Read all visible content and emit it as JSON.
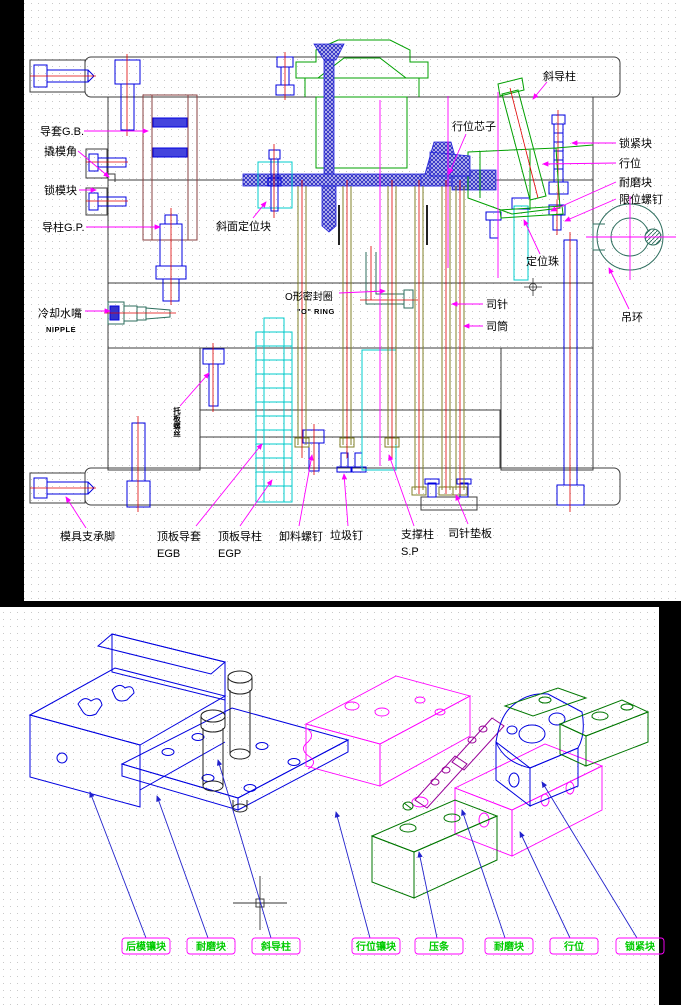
{
  "drawing": {
    "type": "mold-design-cad-drawing",
    "colors": {
      "background": "#000000",
      "paper": "#ffffff",
      "grid_dot": "#c9c9c9",
      "outline": "#3c3c3c",
      "blue": "#0000e0",
      "magenta": "#ff00ff",
      "green": "#00a000",
      "bright_green": "#00cc00",
      "cyan": "#00cccc",
      "red_centerline": "#e00000",
      "olive": "#808028",
      "dark_green": "#2e6e5e",
      "purple": "#990099"
    }
  },
  "top_view": {
    "labels": {
      "guide_bushing": "导套G.B.",
      "pry_slot": "撬模角",
      "mold_lock_block": "锁模块",
      "guide_pin": "导柱G.P.",
      "taper_locating_block": "斜面定位块",
      "cooling_nipple": "冷却水嘴",
      "cooling_nipple_en": "NIPPLE",
      "o_ring": "O形密封圈",
      "o_ring_en": "\"O\" RING",
      "angle_pin": "斜导柱",
      "slide_core": "行位芯子",
      "locking_block": "锁紧块",
      "slide": "行位",
      "wear_block": "耐磨块",
      "limit_screw": "限位螺钉",
      "locating_ball": "定位珠",
      "lifting_ring": "吊环",
      "sleeve_pin": "司针",
      "sleeve": "司筒",
      "vertical_note": "托板螺丝",
      "support_foot": "模具支承脚",
      "ejector_guide_bushing": "顶板导套",
      "ejector_guide_bushing_code": "EGB",
      "ejector_guide_pin": "顶板导柱",
      "ejector_guide_pin_code": "EGP",
      "stripper_screw": "卸料螺钉",
      "stop_pin": "垃圾钉",
      "support_pillar": "支撑柱",
      "support_pillar_code": "S.P",
      "sleeve_pin_plate": "司针垫板"
    }
  },
  "bottom_view": {
    "labels": [
      "后模镶块",
      "耐磨块",
      "斜导柱",
      "行位镶块",
      "压条",
      "耐磨块",
      "行位",
      "锁紧块"
    ]
  }
}
